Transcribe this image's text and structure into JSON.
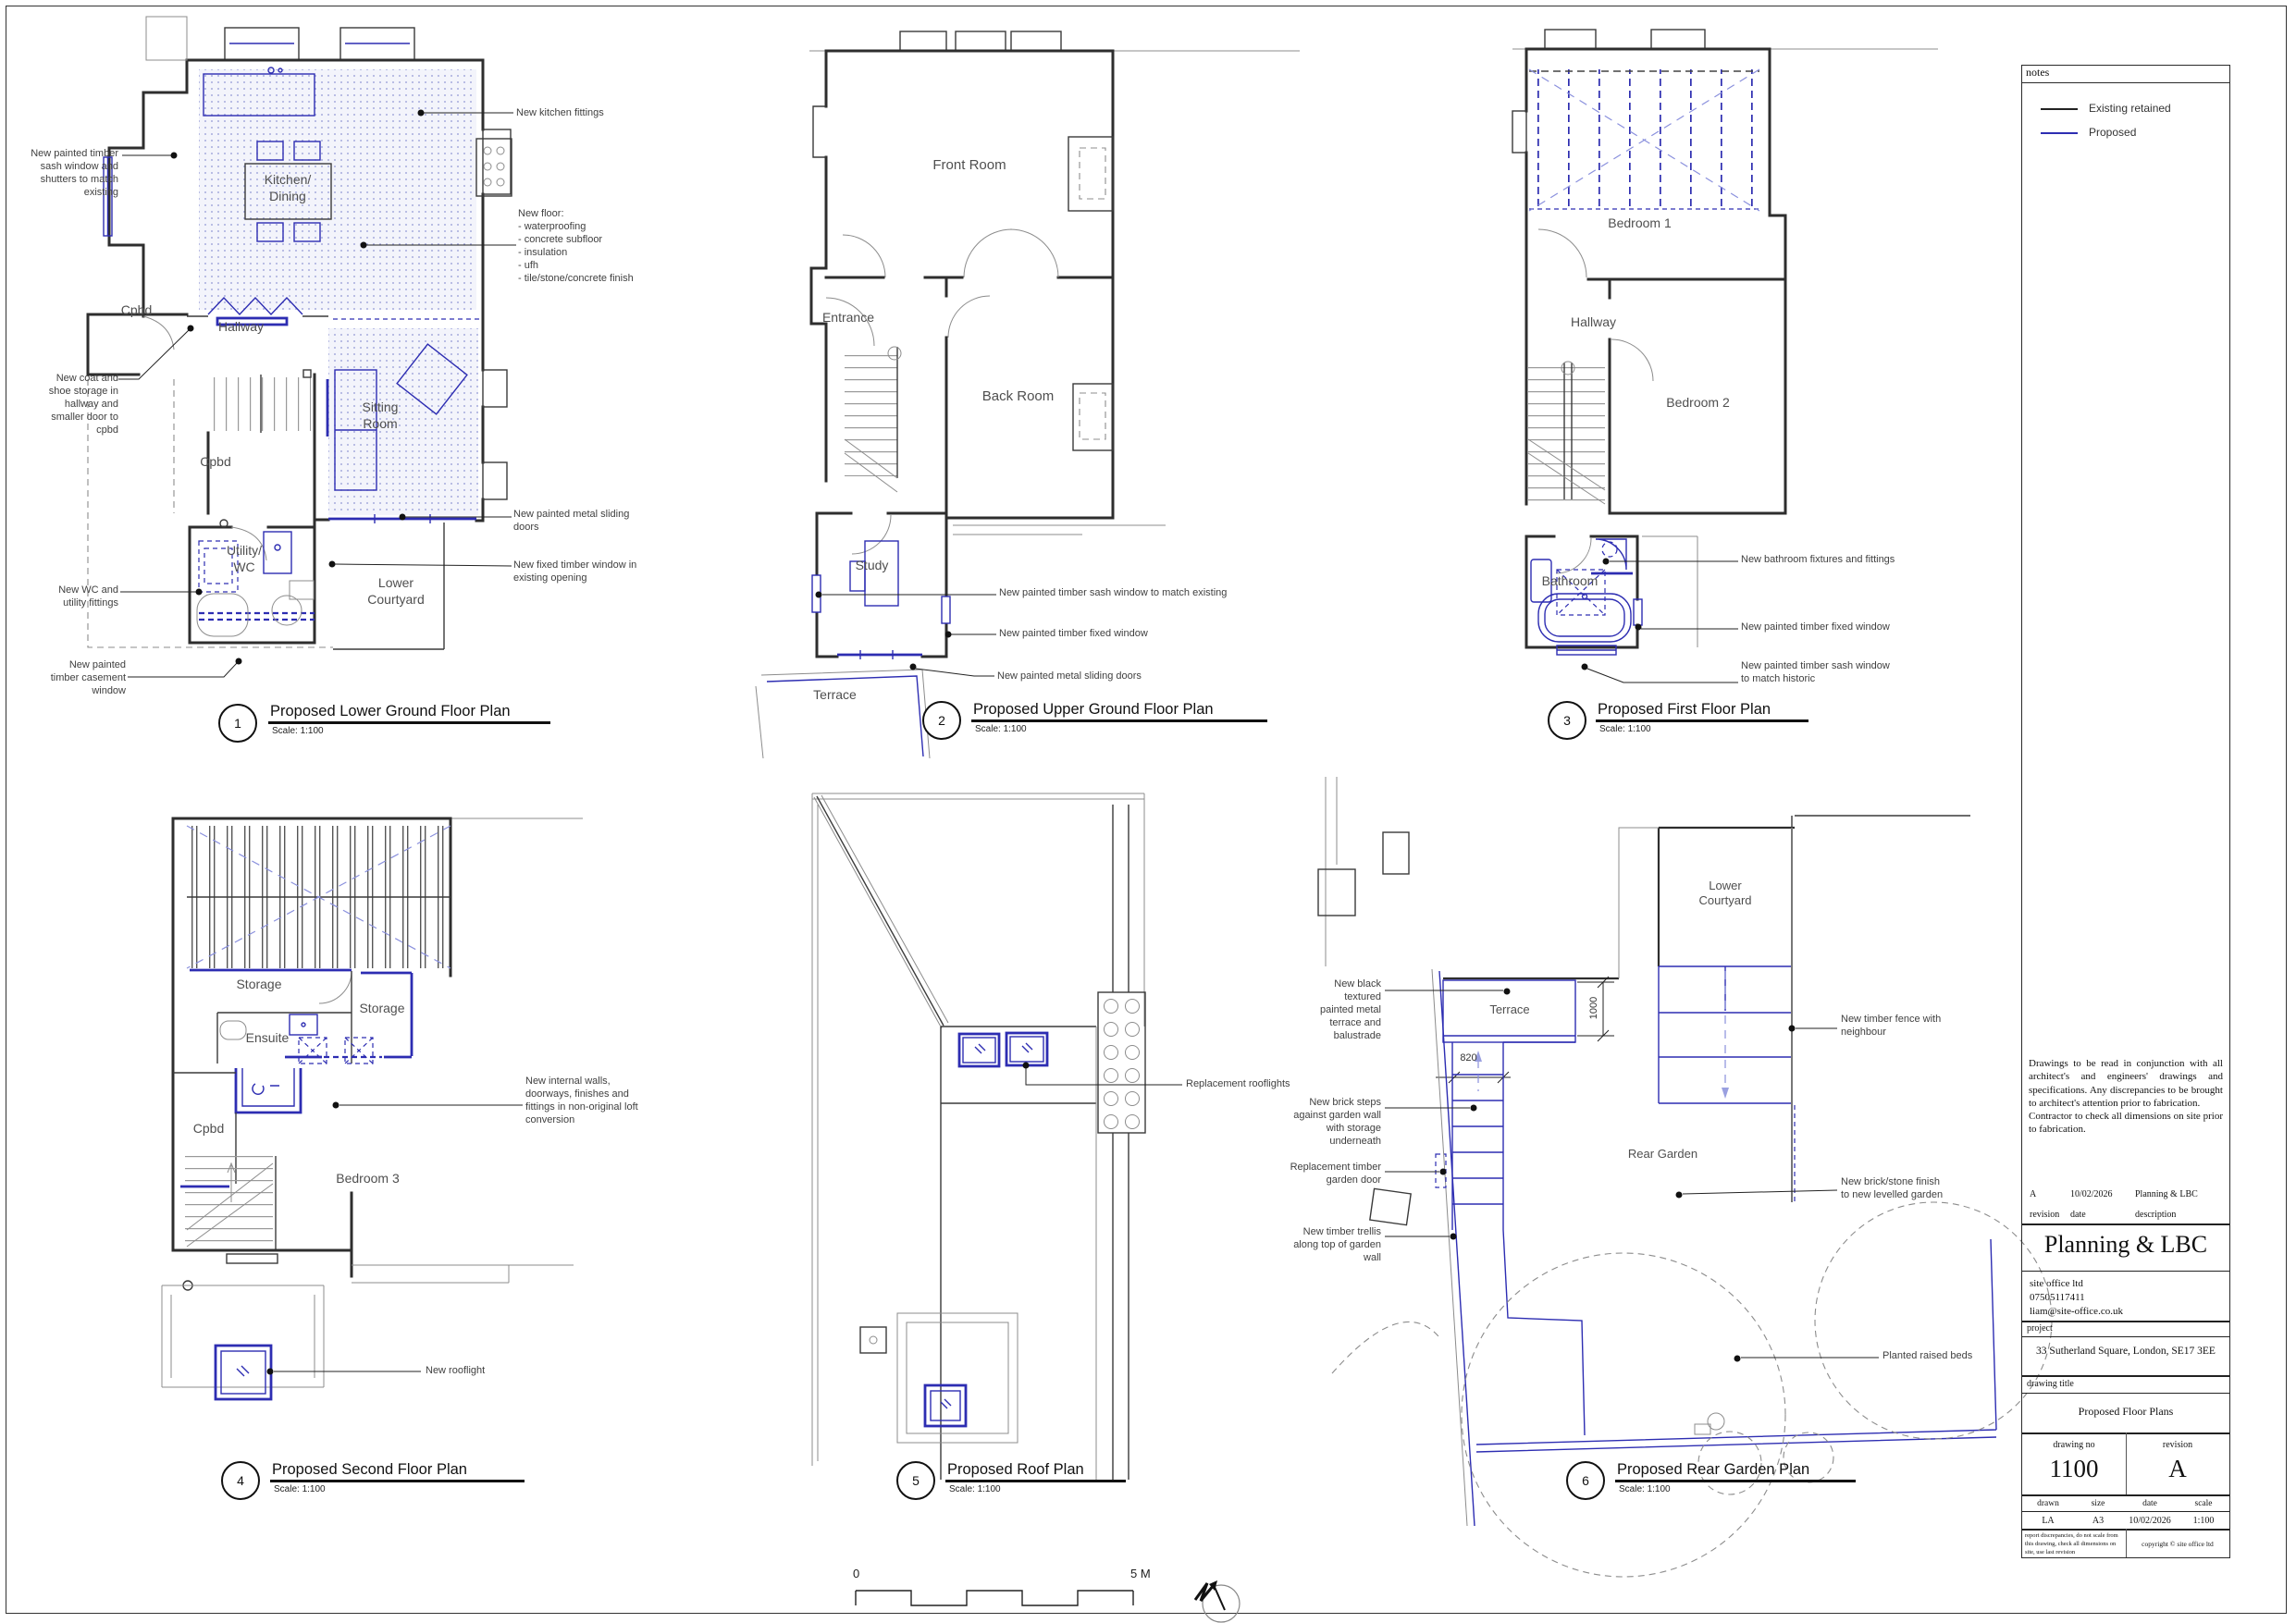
{
  "sheet": {
    "scale_zero": "0",
    "scale_five": "5 M"
  },
  "notes": {
    "header": "notes",
    "legend_existing": "Existing retained",
    "legend_proposed": "Proposed"
  },
  "plans": [
    {
      "number": "1",
      "title": "Proposed Lower Ground Floor Plan",
      "scale": "Scale: 1:100",
      "rooms": {
        "kitchen": "Kitchen/\nDining",
        "cpbd1": "Cpbd",
        "hallway": "Hallway",
        "cpbd2": "Cpbd",
        "sitting": "Sitting\nRoom",
        "utility": "Utility/\nWC",
        "courtyard": "Lower\nCourtyard"
      },
      "ann": {
        "sash": "New painted timber\nsash window and\nshutters to match\nexisting",
        "coat": "New coat and\nshoe storage in\nhallway and\nsmaller door to\ncpbd",
        "wc": "New WC and\nutility fittings",
        "casement": "New painted\ntimber casement\nwindow",
        "kitchen_fittings": "New kitchen fittings",
        "floor": "New floor:\n- waterproofing\n- concrete subfloor\n- insulation\n- ufh\n- tile/stone/concrete finish",
        "sliding": "New painted metal sliding\ndoors",
        "fixed": "New fixed timber window in\nexisting opening"
      }
    },
    {
      "number": "2",
      "title": "Proposed Upper Ground Floor Plan",
      "scale": "Scale: 1:100",
      "rooms": {
        "front": "Front Room",
        "entrance": "Entrance",
        "back": "Back Room",
        "study": "Study",
        "terrace": "Terrace"
      },
      "ann": {
        "sash": "New painted timber sash window to match existing",
        "fixed": "New painted timber fixed window",
        "sliding": "New painted metal sliding doors"
      }
    },
    {
      "number": "3",
      "title": "Proposed First Floor Plan",
      "scale": "Scale: 1:100",
      "rooms": {
        "bed1": "Bedroom 1",
        "hallway": "Hallway",
        "bed2": "Bedroom 2",
        "bathroom": "Bathroom"
      },
      "ann": {
        "fixtures": "New bathroom fixtures and fittings",
        "fixed": "New painted timber fixed window",
        "sash": "New painted timber sash window\nto match historic"
      }
    },
    {
      "number": "4",
      "title": "Proposed Second Floor Plan",
      "scale": "Scale: 1:100",
      "rooms": {
        "storage1": "Storage",
        "storage2": "Storage",
        "ensuite": "Ensuite",
        "cpbd": "Cpbd",
        "bed3": "Bedroom 3"
      },
      "ann": {
        "internal": "New internal walls,\ndoorways, finishes and\nfittings in non-original loft\nconversion",
        "rooflight": "New rooflight"
      }
    },
    {
      "number": "5",
      "title": "Proposed Roof Plan",
      "scale": "Scale: 1:100",
      "ann": {
        "rooflights": "Replacement rooflights"
      }
    },
    {
      "number": "6",
      "title": "Proposed Rear Garden Plan",
      "scale": "Scale: 1:100",
      "labels": {
        "terrace": "Terrace",
        "rear_garden": "Rear Garden",
        "courtyard": "Lower\nCourtyard"
      },
      "dims": {
        "d1000": "1000",
        "d820": "820"
      },
      "ann": {
        "terrace": "New black\ntextured\npainted metal\nterrace and\nbalustrade",
        "steps": "New brick steps\nagainst garden wall\nwith storage\nunderneath",
        "door": "Replacement timber\ngarden door",
        "trellis": "New timber trellis\nalong top of garden\nwall",
        "fence": "New timber fence with\nneighbour",
        "finish": "New brick/stone finish\nto new levelled garden",
        "beds": "Planted raised beds"
      }
    }
  ],
  "title_block": {
    "disclaimer": "Drawings to be read in conjunction with all architect's and engineers' drawings and specifications. Any discrepancies to be brought to architect's attention prior to fabrication.\nContractor to check all dimensions on site prior to fabrication.",
    "revision_entry": {
      "revision": "A",
      "date": "10/02/2026",
      "description": "Planning & LBC"
    },
    "revision_headers": {
      "revision": "revision",
      "date": "date",
      "description": "description"
    },
    "stage_title": "Planning & LBC",
    "contact": "site office ltd\n07505117411\nliam@site-office.co.uk",
    "project_label": "project",
    "project": "33 Sutherland Square, London, SE17 3EE",
    "drawing_title_label": "drawing title",
    "drawing_title": "Proposed Floor Plans",
    "drawing_no_label": "drawing no",
    "drawing_no": "1100",
    "revision_label": "revision",
    "revision": "A",
    "drawn_label": "drawn",
    "drawn": "LA",
    "size_label": "size",
    "size": "A3",
    "date_label": "date",
    "date": "10/02/2026",
    "scale_label": "scale",
    "scale": "1:100",
    "footer_note": "report discrepancies, do not scale from this drawing, check all dimensions on site, use last revision",
    "copyright": "copyright © site office ltd"
  }
}
